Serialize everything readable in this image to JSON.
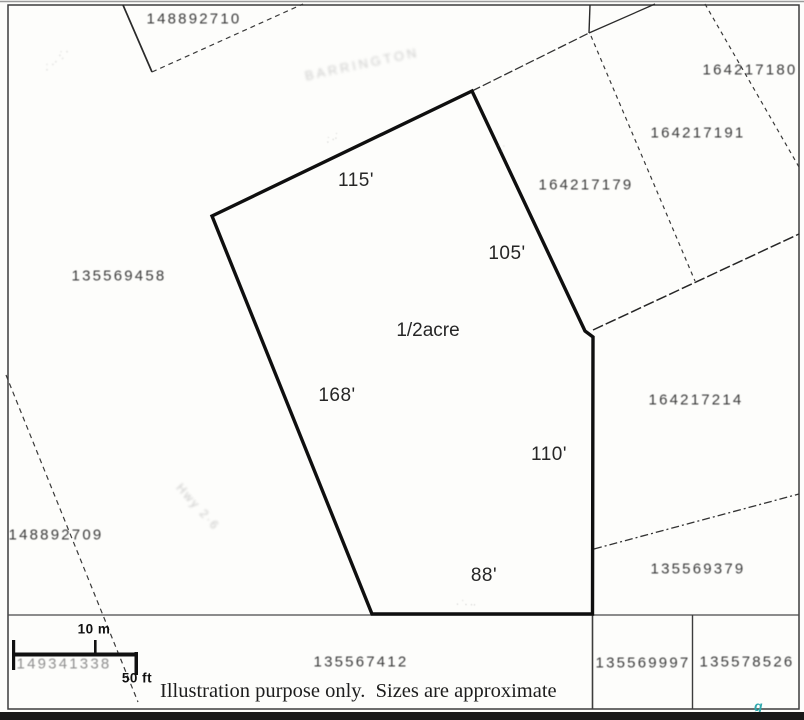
{
  "map": {
    "disclaimer": "Illustration purpose only.  Sizes are approximate",
    "subject_parcel": {
      "area": "1/2acre",
      "dim_top": "115'",
      "dim_upper_right": "105'",
      "dim_right": "110'",
      "dim_bottom": "88'",
      "dim_left": "168'"
    },
    "scale_bar": {
      "metric": "10 m",
      "imperial": "50 ft"
    },
    "parcels": [
      {
        "id": "148892710"
      },
      {
        "id": "164217180"
      },
      {
        "id": "164217191"
      },
      {
        "id": "164217179"
      },
      {
        "id": "135569458"
      },
      {
        "id": "164217214"
      },
      {
        "id": "148892709"
      },
      {
        "id": "135569379"
      },
      {
        "id": "149341338"
      },
      {
        "id": "135567412"
      },
      {
        "id": "135569997"
      },
      {
        "id": "135578526"
      }
    ],
    "faint_marks": [
      {
        "text": "·˙·· :˙·"
      },
      {
        "text": "BARRINGTON"
      },
      {
        "text": "Hwy 2·6"
      },
      {
        "text": "·˙··˙"
      },
      {
        "text": "·˙·"
      },
      {
        "text": "· ˙· ··"
      }
    ],
    "ink_mark": "g",
    "colors": {
      "line": "#1a1a1a",
      "teal_ink": "#2fa8ad"
    }
  }
}
